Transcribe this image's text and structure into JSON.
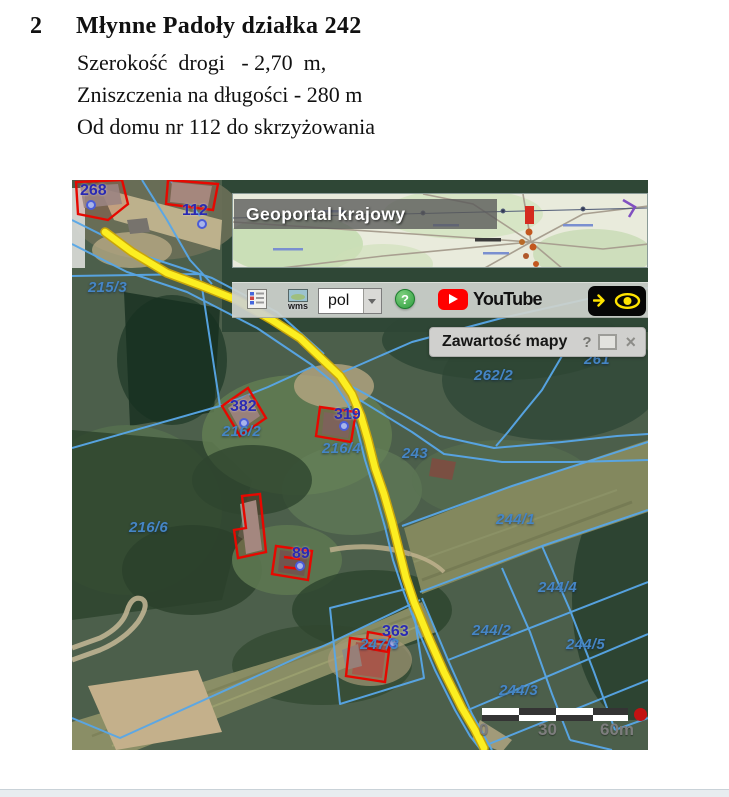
{
  "document": {
    "item_number": "2",
    "title": "Młynne Padoły działka 242",
    "line1": "Szerokość  drogi   - 2,70  m,",
    "line2": "Zniszczenia na długości - 280 m",
    "line3": "Od domu nr 112 do skrzyżowania"
  },
  "map": {
    "inset": {
      "banner": "Geoportal krajowy"
    },
    "toolbar": {
      "wms_label": "wms",
      "language_value": "pol",
      "help_label": "?",
      "youtube_label": "YouTube"
    },
    "layers_panel": {
      "title": "Zawartość mapy",
      "help_button": "?",
      "close_button": "×"
    },
    "scalebar": {
      "tick0": "0",
      "tick1": "30",
      "tick2": "60m"
    },
    "building_labels": {
      "b268": "268",
      "b112": "112",
      "b382": "382",
      "b319": "319",
      "b89": "89",
      "b363": "363"
    },
    "parcel_labels": {
      "p215_3": "215/3",
      "p216_2": "216/2",
      "p216_4": "216/4",
      "p243": "243",
      "p262_2": "262/2",
      "p261": "261",
      "p216_6": "216/6",
      "p244_1": "244/1",
      "p244_4": "244/4",
      "p244_2": "244/2",
      "p244_5": "244/5",
      "p244_3": "244/3",
      "p247_3": "247/3"
    },
    "colors": {
      "parcel_line": "#58a7e8",
      "building_outline": "#e60800",
      "road_highlight": "#fcee21",
      "building_label": "#2a2ab2",
      "parcel_label": "#4585c5"
    }
  }
}
